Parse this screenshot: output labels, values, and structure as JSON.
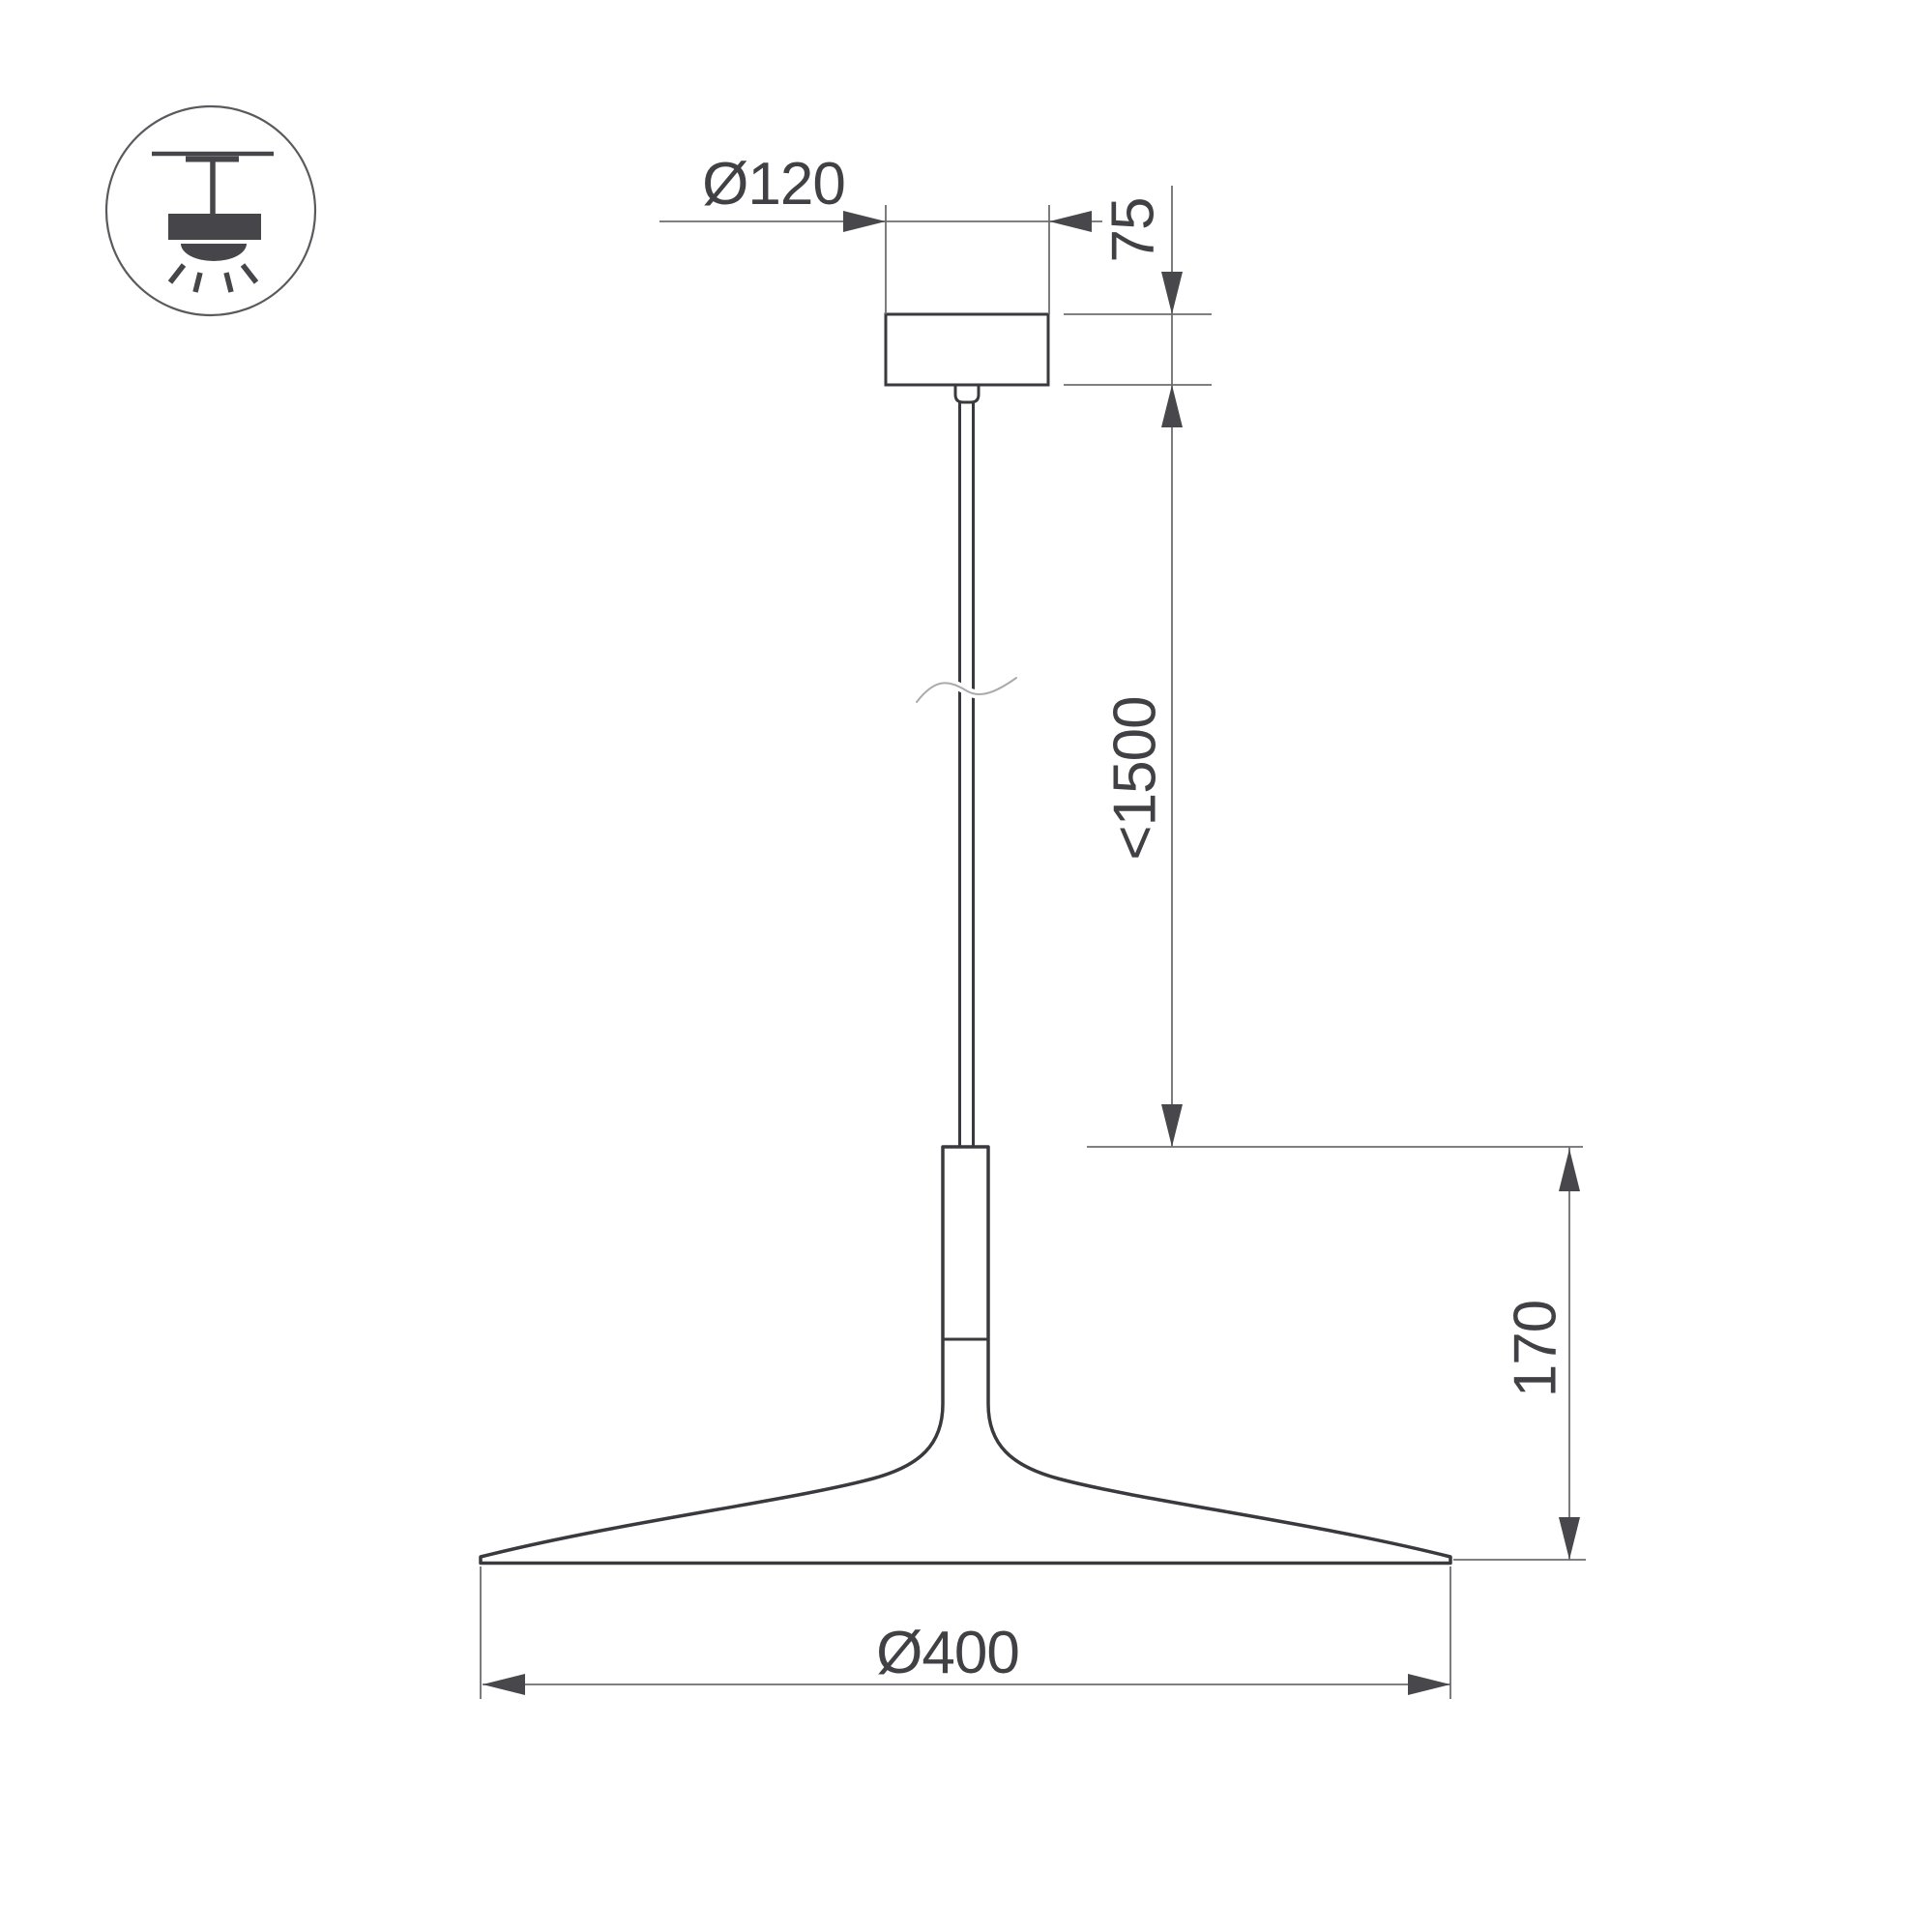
{
  "title": "Pendant luminaire dimensional drawing",
  "colors": {
    "background": "#ffffff",
    "object_line": "#3a3a3e",
    "dimension_line": "#6e6e70",
    "arrow": "#48484c",
    "text": "#414145",
    "icon": "#45454a"
  },
  "icon": {
    "name": "pendant-ceiling-light"
  },
  "dimensions": {
    "canopy_diameter": "Ø120",
    "canopy_height": "75",
    "suspension_length": "<1500",
    "shade_height": "170",
    "shade_diameter": "Ø400"
  }
}
